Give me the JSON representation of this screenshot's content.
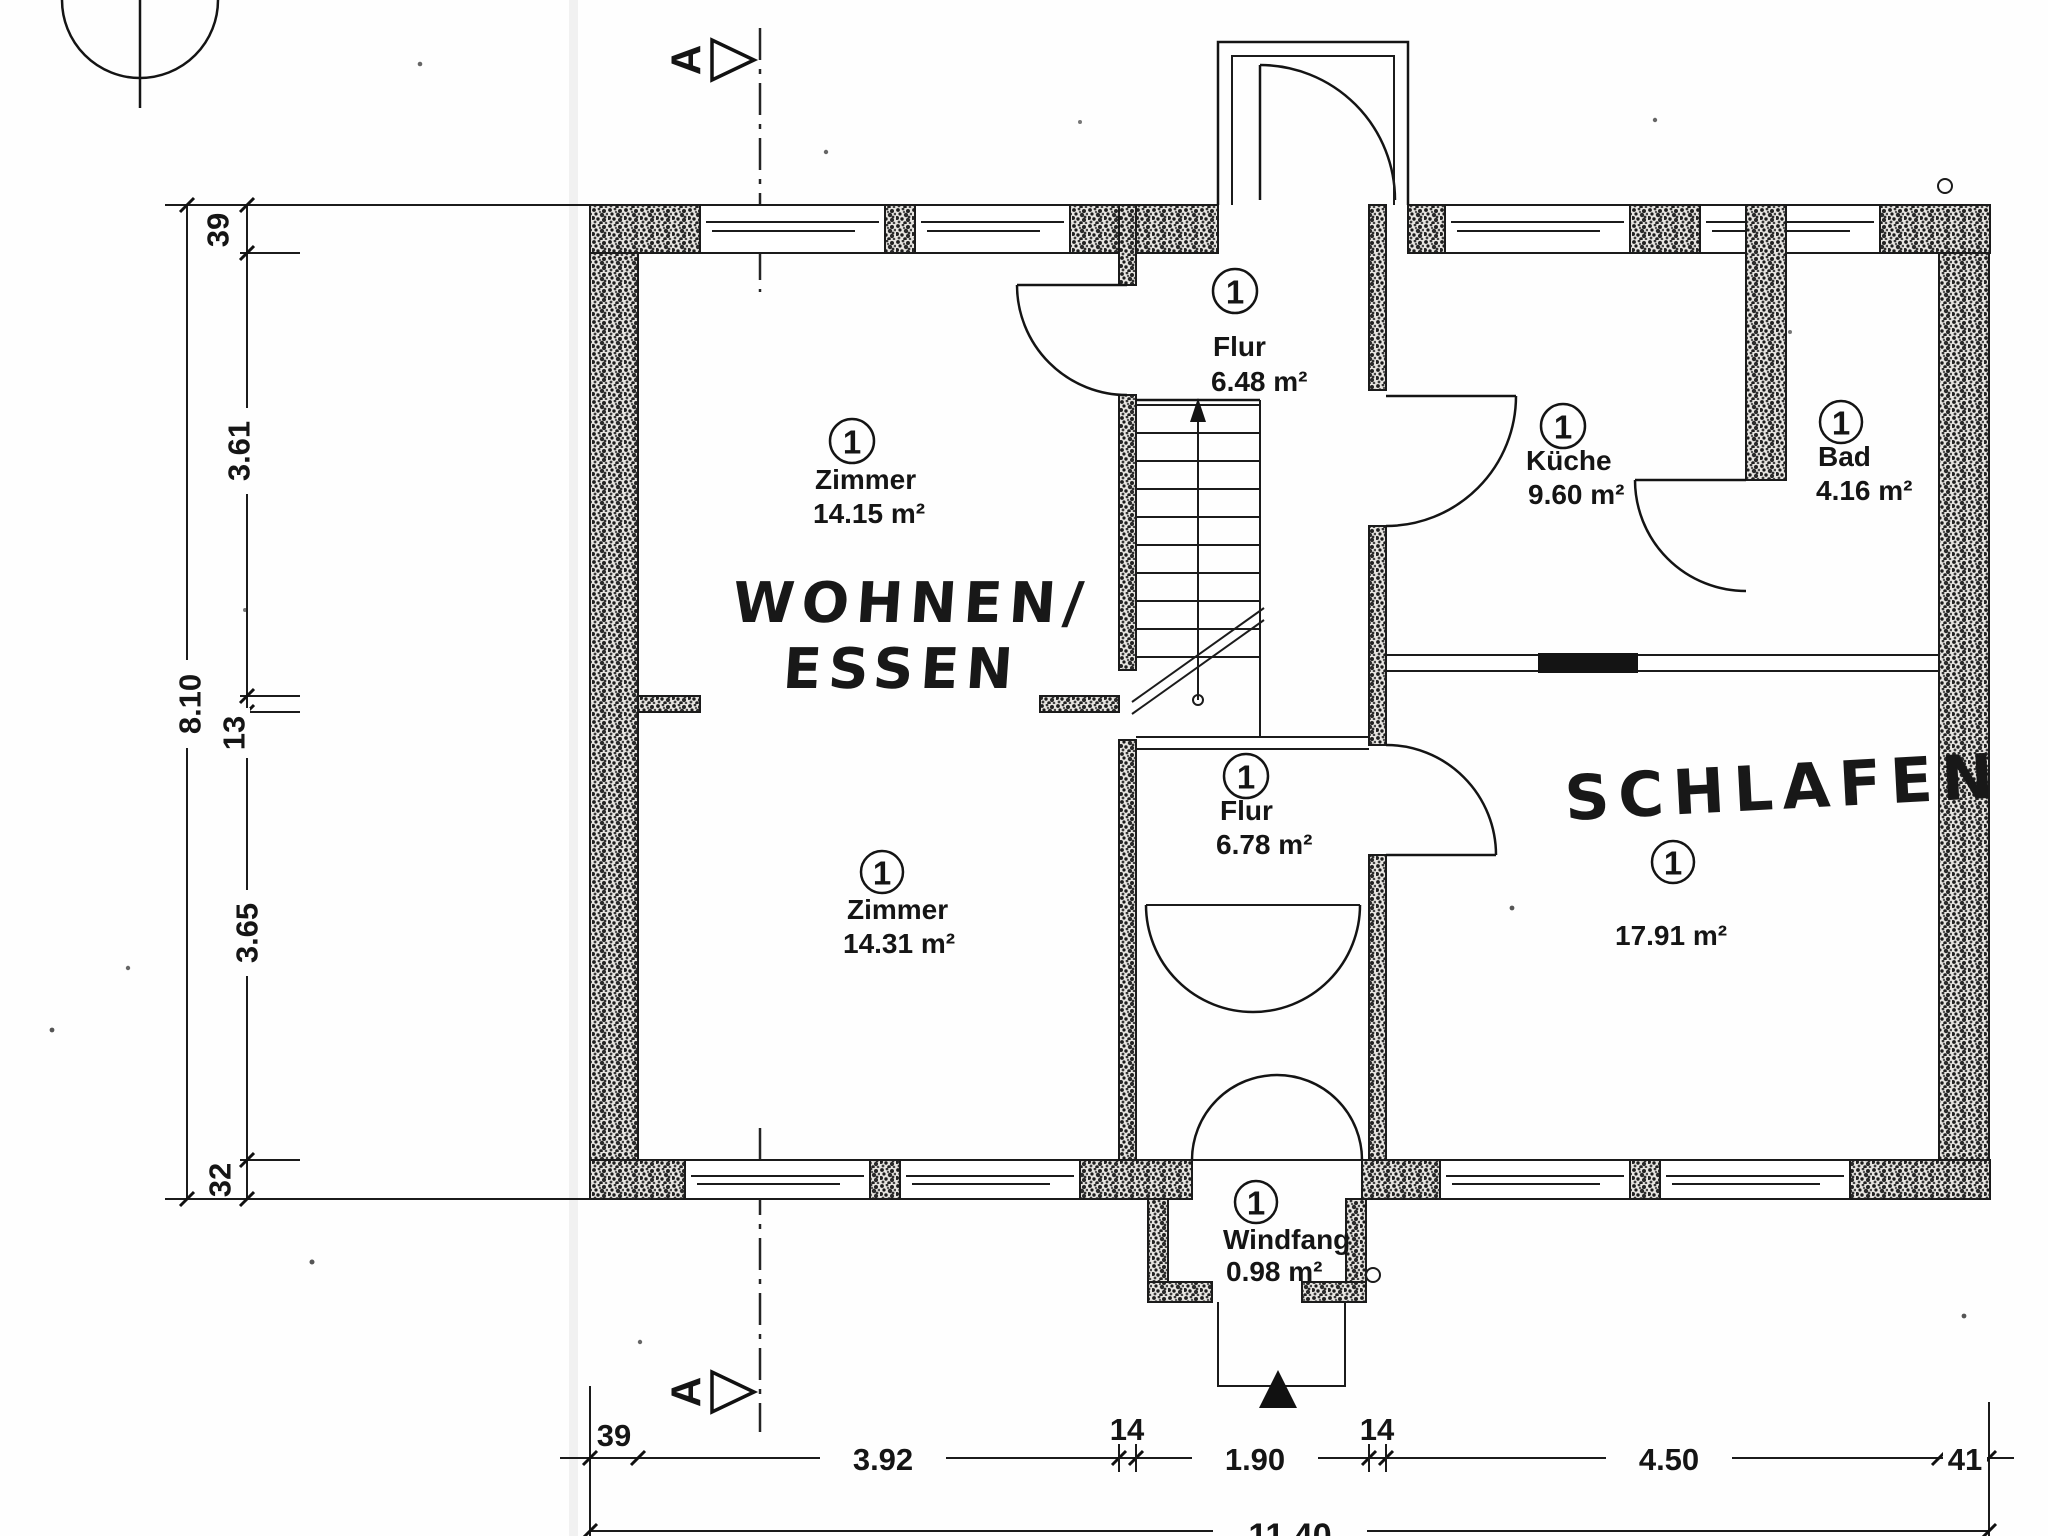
{
  "plan": {
    "section_label": "A",
    "rooms": {
      "flur_top": {
        "number": "1",
        "name": "Flur",
        "area": "6.48 m²"
      },
      "zimmer_top": {
        "number": "1",
        "name": "Zimmer",
        "area": "14.15 m²"
      },
      "kueche": {
        "number": "1",
        "name": "Küche",
        "area": "9.60 m²"
      },
      "bad": {
        "number": "1",
        "name": "Bad",
        "area": "4.16 m²"
      },
      "flur_mid": {
        "number": "1",
        "name": "Flur",
        "area": "6.78 m²"
      },
      "zimmer_bottom": {
        "number": "1",
        "name": "Zimmer",
        "area": "14.31 m²"
      },
      "schlafen": {
        "number": "1",
        "area": "17.91 m²"
      },
      "windfang": {
        "number": "1",
        "name": "Windfang",
        "area": "0.98 m²"
      }
    },
    "handwritten": {
      "wohnen_line1": "WOHNEN/",
      "wohnen_line2": "ESSEN",
      "schlafen": "SCHLAFEN"
    },
    "dimensions": {
      "left": {
        "total": "8.10",
        "segments": [
          "39",
          "3.61",
          "13",
          "3.65",
          "32"
        ]
      },
      "bottom": {
        "total": "11.40",
        "segments": [
          "39",
          "3.92",
          "14",
          "1.90",
          "14",
          "4.50",
          "41"
        ]
      }
    }
  }
}
